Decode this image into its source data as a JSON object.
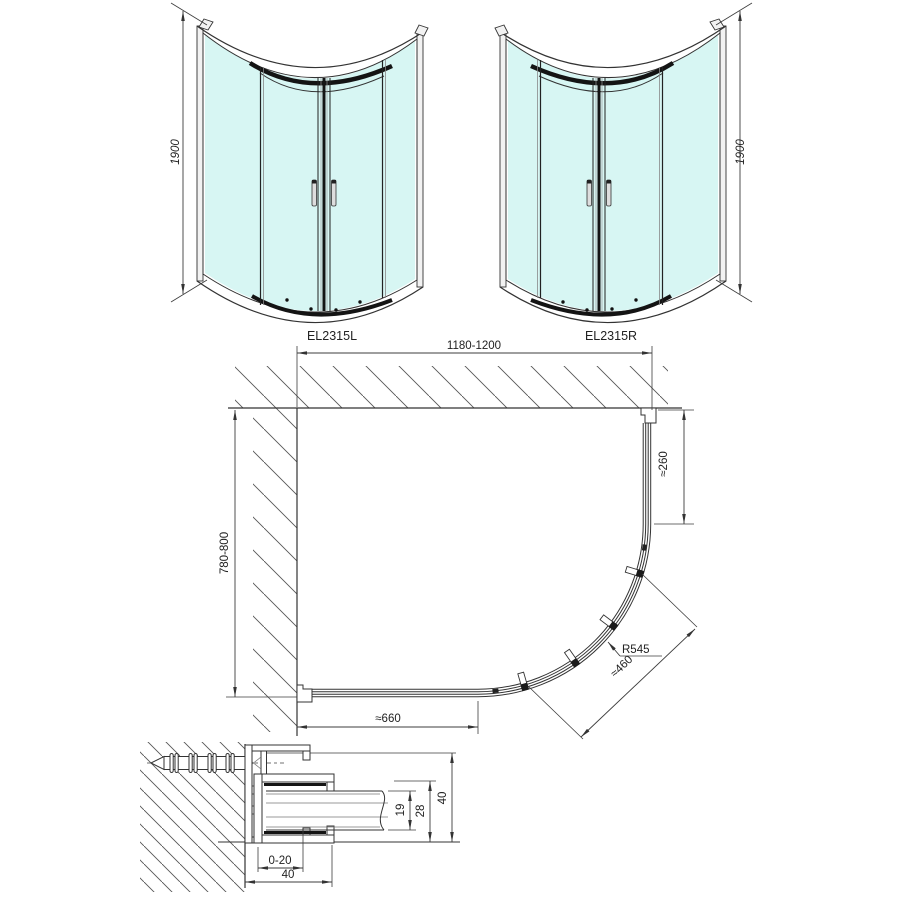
{
  "drawing": {
    "front_left": {
      "label": "EL2315L",
      "height_dim": "1900"
    },
    "front_right": {
      "label": "EL2315R",
      "height_dim": "1900"
    },
    "plan": {
      "width_dim": "1180-1200",
      "depth_dim": "780-800",
      "entry_right_dim": "≈260",
      "radius_dim": "R545",
      "diagonal_dim": "≈460",
      "entry_bottom_dim": "≈660"
    },
    "section": {
      "glass_dim": "19",
      "channel_dim": "28",
      "height_dim": "40",
      "adjust_dim": "0-20",
      "width_dim": "40"
    }
  },
  "colors": {
    "glass": "#d7f6f3",
    "line": "#333333",
    "dark": "#141414"
  }
}
